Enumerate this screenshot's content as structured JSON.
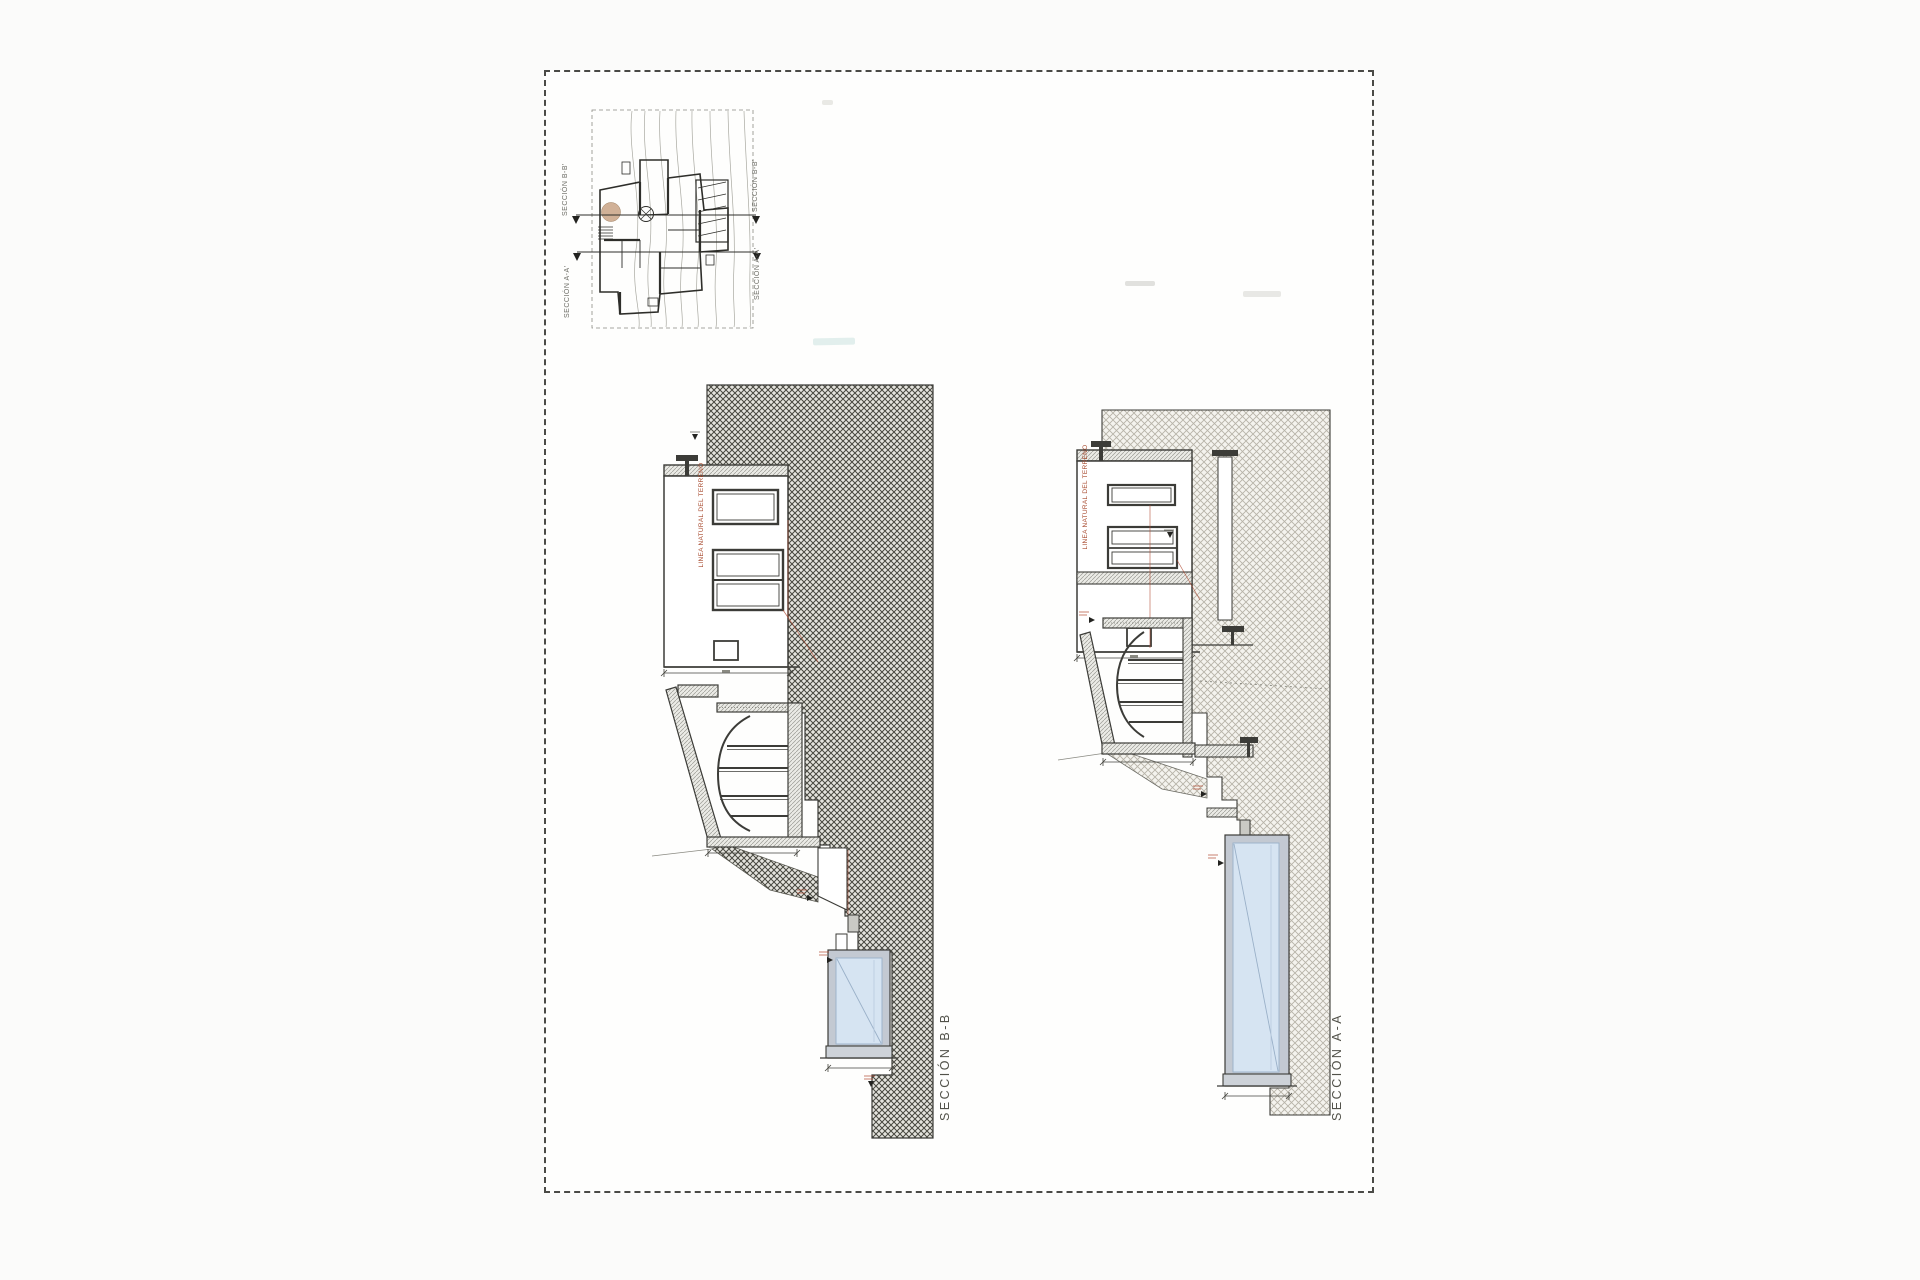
{
  "sheet": {
    "type": "architectural section drawing sheet",
    "border_style": "dashed"
  },
  "site_plan": {
    "description": "small key plan with topographic contours, house floor plan and section cut lines",
    "labels": {
      "bb_left": "SECCIÓN B-B'",
      "bb_right": "SECCIÓN B-B'",
      "aa_left": "SECCIÓN A-A'",
      "aa_right": "SECCIÓN A-A'"
    }
  },
  "sections": {
    "bb": {
      "label": "SECCIÓN B-B",
      "terrain_line_label": "LINEA NATURAL DEL TERRENO",
      "features": [
        "earth cross-hatch dark",
        "two-storey house section",
        "barrel vault room",
        "sloped buttress wall",
        "terraced steps",
        "swimming pool"
      ]
    },
    "aa": {
      "label": "SECCIÓN A-A",
      "terrain_line_label": "LINEA NATURAL DEL TERRENO",
      "features": [
        "earth cross-hatch light",
        "two-storey house section",
        "barrel vault room",
        "sloped buttress wall",
        "light-well shaft with railing",
        "terraced steps",
        "swimming pool (long cut)"
      ]
    }
  },
  "colors": {
    "line": "#3c3c38",
    "earth_hatch_dark": "#47473f",
    "earth_hatch_light": "#b7b3a8",
    "wall_hatch": "#9a9a94",
    "pool_water": "#d6e4f2",
    "pool_wall": "#c3c9d2",
    "terrain_text_red": "#a84b2f",
    "annotation_red": "#b04a32",
    "label_gray": "#52524a",
    "sheet_border": "#4a4a46"
  }
}
